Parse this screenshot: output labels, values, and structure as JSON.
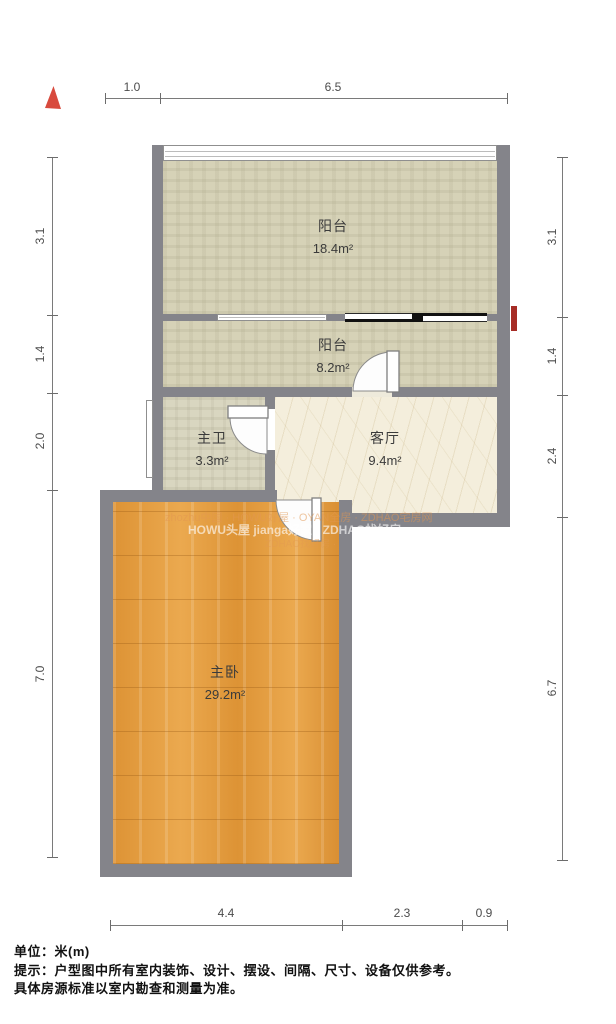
{
  "compass": {
    "name": "north-indicator"
  },
  "rooms": [
    {
      "name": "阳台",
      "area": "18.4m²"
    },
    {
      "name": "阳台",
      "area": "8.2m²"
    },
    {
      "name": "主卫",
      "area": "3.3m²"
    },
    {
      "name": "客厅",
      "area": "9.4m²"
    },
    {
      "name": "主卧",
      "area": "29.2m²"
    }
  ],
  "dimensions": {
    "unit_note": "米(m)",
    "top": [
      "1.0",
      "6.5"
    ],
    "bottom": [
      "4.4",
      "2.3",
      "0.9"
    ],
    "left": [
      "3.1",
      "1.4",
      "2.0",
      "7.0"
    ],
    "right": [
      "3.1",
      "1.4",
      "2.4",
      "6.7"
    ]
  },
  "watermarks": [
    "zhozhu中国 · HOWU好屋 · OYAN全房 · ZDHAO宅房网",
    "HOWU头屋 jianga好家 · ZDHAO找好房",
    "ZDHAO找好房 ·"
  ],
  "footer": {
    "line1": "单位：米(m)",
    "line2": "提示：户型图中所有室内装饰、设计、摆设、间隔、尺寸、设备仅供参考。",
    "line3": "具体房源标准以室内勘查和测量为准。"
  },
  "colors": {
    "wall": "#84848a",
    "balcony_floor": "#d6d2b7",
    "living_floor": "#f4eedc",
    "bedroom_floor": "#e0993c",
    "compass_red": "#d84a3d",
    "entry_mark_red": "#a62c26"
  }
}
